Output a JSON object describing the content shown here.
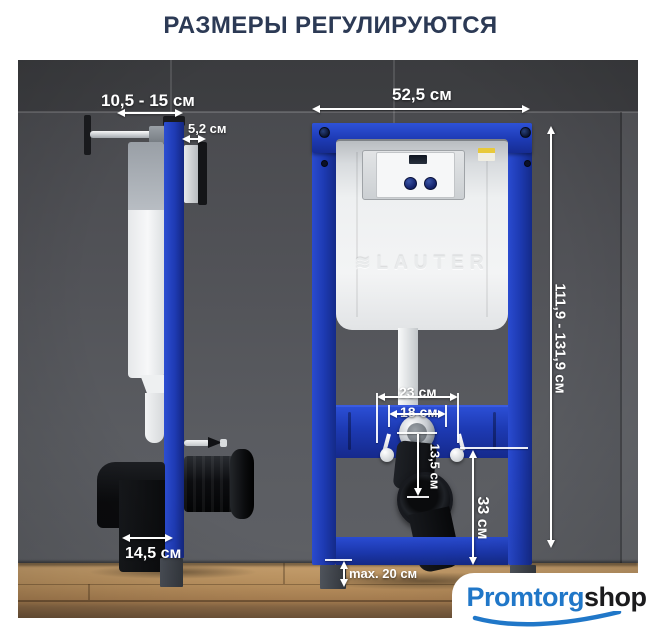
{
  "title": "РАЗМЕРЫ РЕГУЛИРУЮТСЯ",
  "product": {
    "brand_embossed": "LAUTER",
    "icons": {
      "brand_mark": "≋"
    }
  },
  "dims": {
    "wall_offset_range": "10,5 - 15 см",
    "profile_depth": "5,2 см",
    "frame_width": "52,5 см",
    "frame_height_range": "111,9 - 131,9 см",
    "fixing_outer": "23 см",
    "fixing_inner": "18 см",
    "outlet_drop": "13,5 см",
    "drain_axis_height": "33 см",
    "elbow_width": "14,5 см",
    "leg_extension_max": "max. 20 см"
  },
  "watermark": {
    "brand_primary": "Promtorg",
    "brand_secondary": "shop"
  },
  "colors": {
    "frame_blue": "#1d3ab3",
    "title_navy": "#2c3a55",
    "watermark_blue": "#2077c8"
  }
}
